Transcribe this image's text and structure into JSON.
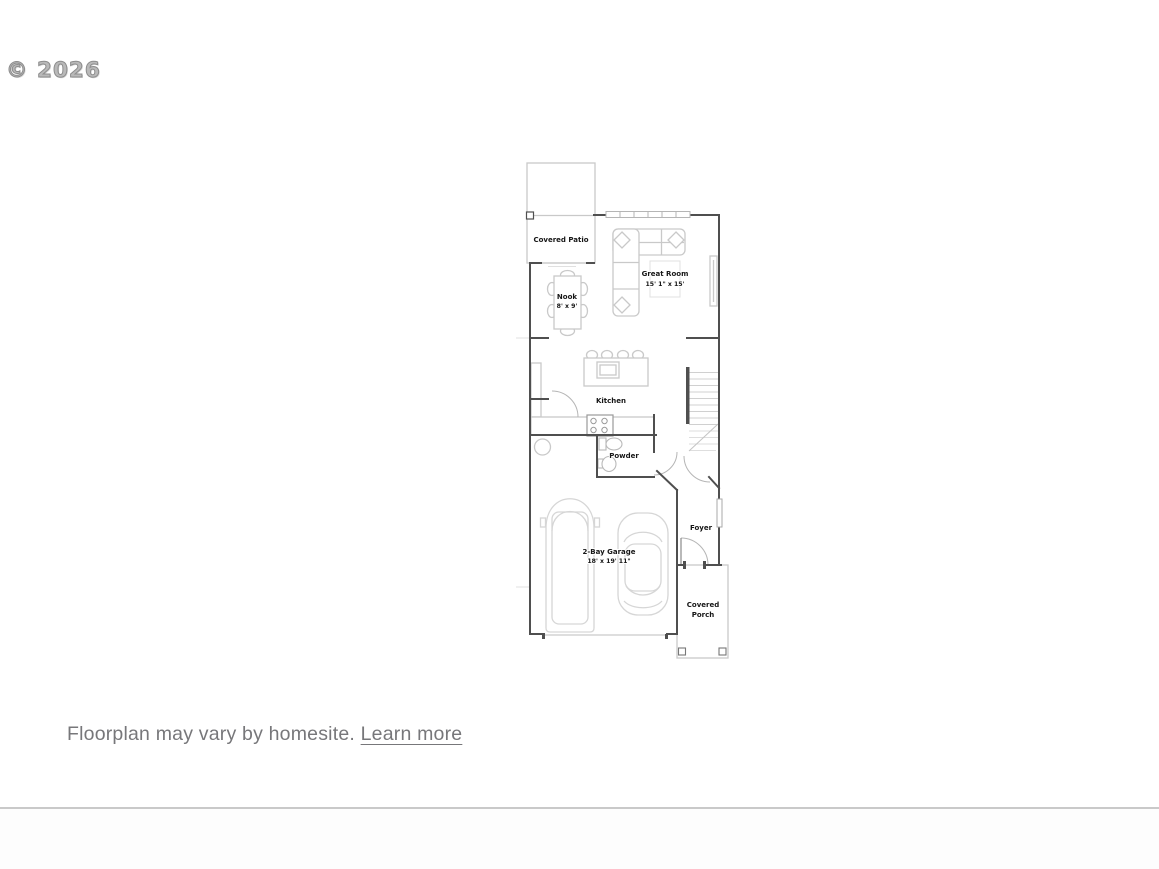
{
  "watermark": "© 2026",
  "footer": {
    "disclaimer": "Floorplan may vary by homesite.",
    "learn_more": "Learn more"
  },
  "floorplan": {
    "rooms": {
      "covered_patio": {
        "label": "Covered Patio"
      },
      "great_room": {
        "label": "Great Room",
        "dims": "15' 1\" x 15'"
      },
      "nook": {
        "label": "Nook",
        "dims": "8' x 9'"
      },
      "kitchen": {
        "label": "Kitchen"
      },
      "powder": {
        "label": "Powder"
      },
      "foyer": {
        "label": "Foyer"
      },
      "garage": {
        "label": "2-Bay Garage",
        "dims": "18' x 19' 11\""
      },
      "covered_porch": {
        "label_line1": "Covered",
        "label_line2": "Porch"
      }
    }
  },
  "colors": {
    "wall": "#4f4f4f",
    "furniture_outline": "#c9c9c9",
    "label_text": "#161616",
    "watermark_gray": "#8d8d8d",
    "footer_text": "#77777a",
    "divider": "#c9c9c9",
    "background": "#ffffff"
  }
}
